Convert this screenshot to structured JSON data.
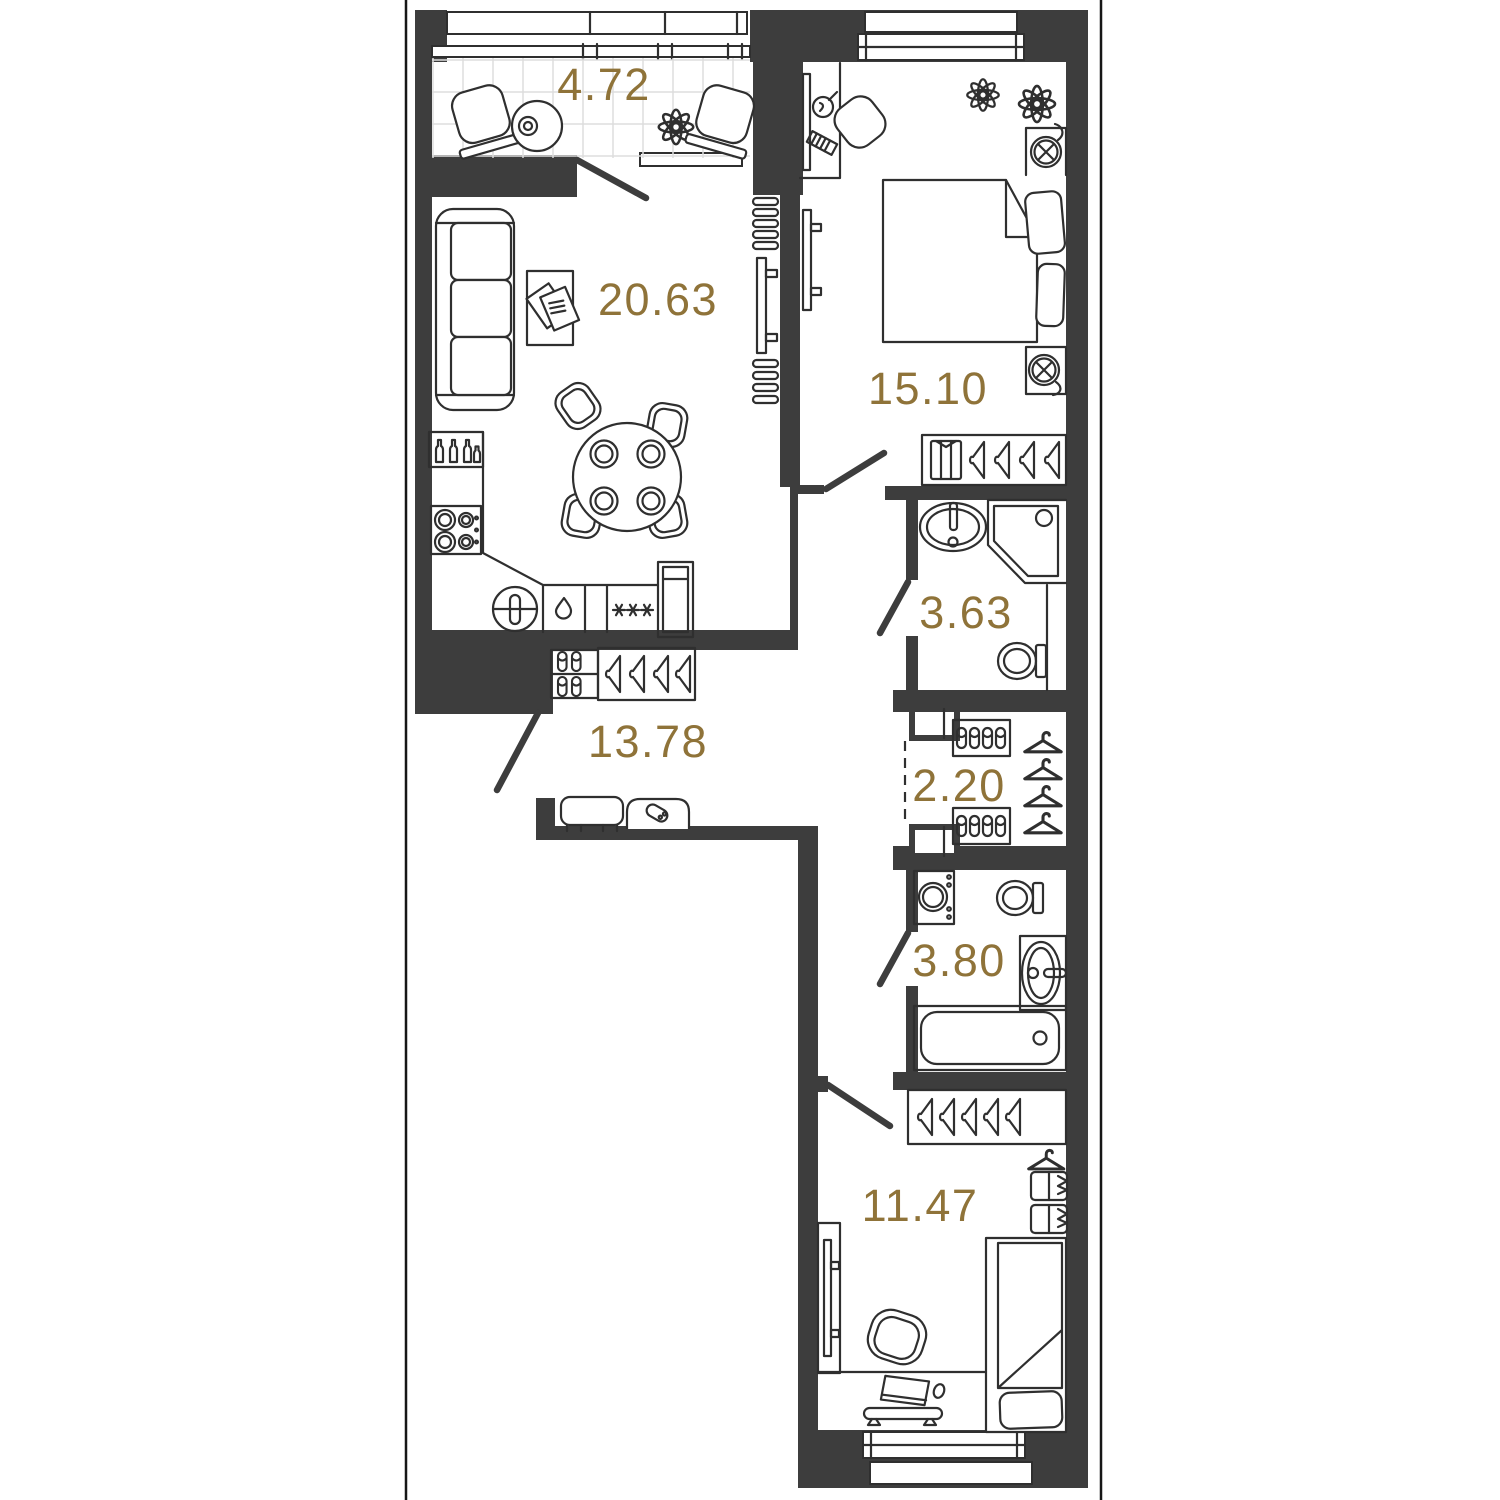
{
  "plan_title": "2-room apartment floor plan",
  "colors": {
    "wall": "#3d3d3d",
    "area_label": "#8f7339",
    "furniture_line": "#2f2f2f",
    "balcony_grid": "#dddddd",
    "background": "#ffffff"
  },
  "rooms": [
    {
      "id": "balcony",
      "area": "4.72",
      "furniture": [
        "lounge-chair",
        "round-side-table",
        "plant",
        "lounge-chair"
      ]
    },
    {
      "id": "living-kitchen",
      "area": "20.63",
      "furniture": [
        "sofa",
        "coffee-table",
        "magazines",
        "dining-table",
        "dining-chairs",
        "wall-shelves",
        "tv",
        "bottle-rack",
        "cooktop",
        "kitchen-sink",
        "dishwasher",
        "appliance-asterisks",
        "fridge"
      ]
    },
    {
      "id": "bedroom-1",
      "area": "15.10",
      "furniture": [
        "desk",
        "desk-lamp",
        "keyboard",
        "desk-chair",
        "tv",
        "plant",
        "plant",
        "nightstand-lamp",
        "double-bed",
        "pillows",
        "nightstand-lamp",
        "wardrobe-shirt-hangers"
      ]
    },
    {
      "id": "bathroom-1",
      "area": "3.63",
      "furniture": [
        "washbasin",
        "corner-shower",
        "toilet"
      ]
    },
    {
      "id": "closet",
      "area": "2.20",
      "furniture": [
        "shoe-shelf",
        "hangers",
        "shoe-shelf",
        "duct-shaft",
        "duct-shaft"
      ]
    },
    {
      "id": "bathroom-2",
      "area": "3.80",
      "furniture": [
        "washing-machine",
        "toilet",
        "washbasin",
        "bathtub"
      ]
    },
    {
      "id": "hallway",
      "area": "13.78",
      "furniture": [
        "shoe-shelf",
        "closet-hangers",
        "bench",
        "pouf-with-shoe"
      ]
    },
    {
      "id": "bedroom-2",
      "area": "11.47",
      "furniture": [
        "wardrobe-hangers",
        "hanger",
        "drawer-shelves",
        "tv",
        "armchair",
        "single-bed",
        "pillow",
        "desk",
        "laptop",
        "mouse",
        "keyboard-shelf"
      ]
    }
  ],
  "doors": [
    "balcony-door",
    "bedroom-1-door",
    "bathroom-1-door",
    "entry-door",
    "bathroom-2-door",
    "bedroom-2-door"
  ],
  "windows": [
    "balcony-glazing",
    "bedroom-1-window",
    "bedroom-2-window"
  ]
}
